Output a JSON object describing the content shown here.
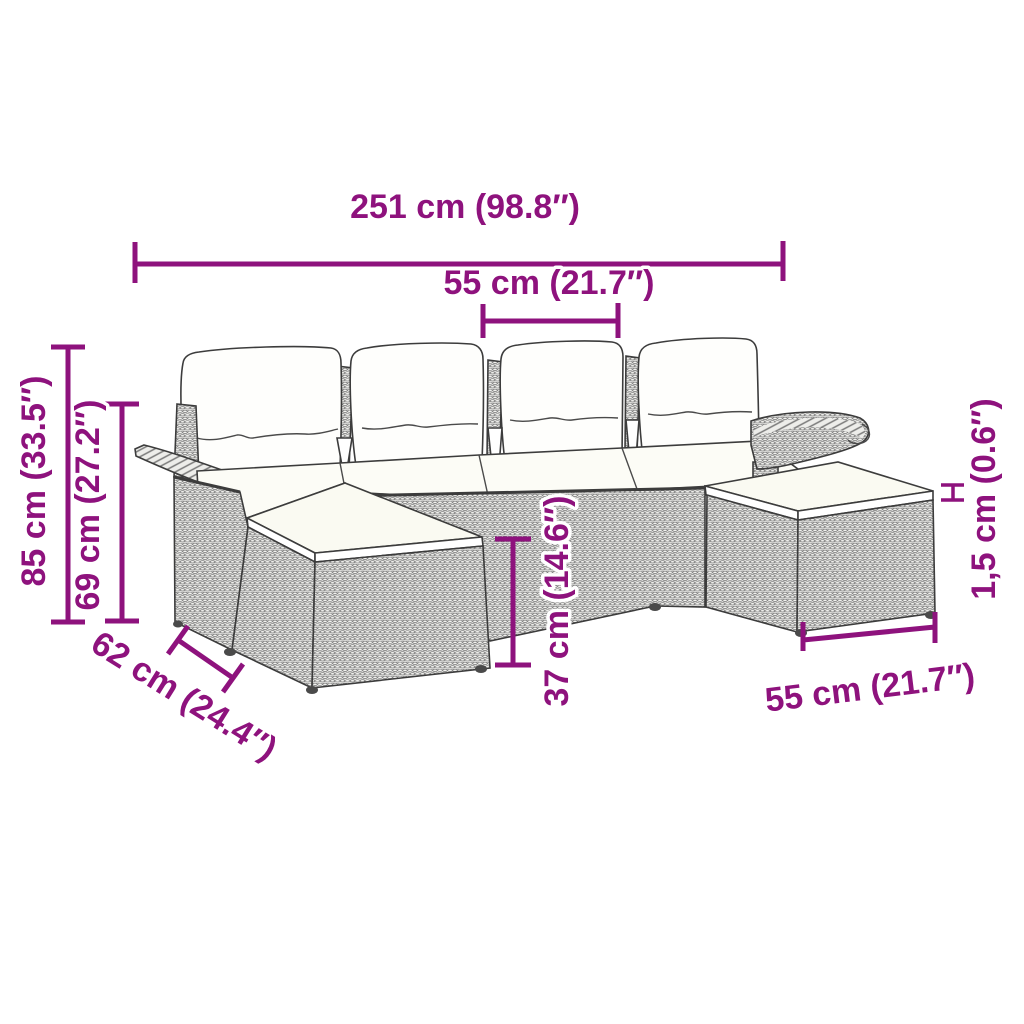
{
  "figure": {
    "accent_color": "#8E127D",
    "line_color": "#3C3C3C",
    "background": "#FFFFFF"
  },
  "dimensions": {
    "overall_width": {
      "label": "251 cm (98.8″)"
    },
    "seat_width": {
      "label": "55 cm (21.7″)"
    },
    "overall_height": {
      "label": "85 cm (33.5″)"
    },
    "backrest_height": {
      "label": "69 cm (27.2″)"
    },
    "seat_depth": {
      "label": "62 cm (24.4″)"
    },
    "base_height": {
      "label": "37 cm (14.6″)"
    },
    "cushion_thickness": {
      "label": "1,5 cm (0.6″)"
    },
    "ottoman_width": {
      "label": "55 cm (21.7″)"
    }
  }
}
